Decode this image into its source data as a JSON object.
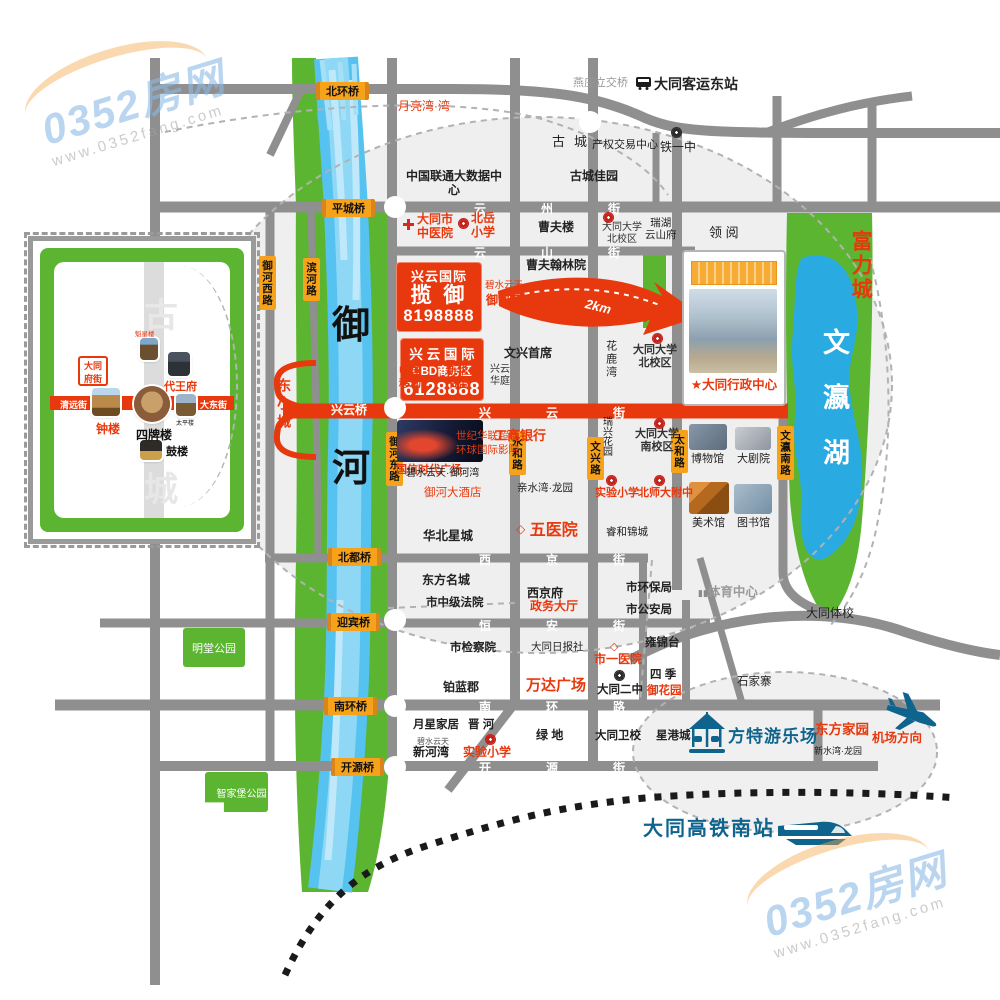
{
  "brand": {
    "name": "0352房网",
    "url": "www.0352fang.com"
  },
  "colors": {
    "red": "#e8380d",
    "orange": "#f7a21b",
    "green": "#5cb531",
    "lake": "#29abe2",
    "river": "#56c2f0",
    "teal": "#0f648e",
    "road": "#8f8f8f"
  },
  "icons": {
    "diamond": "◇",
    "star": "★",
    "building": "▮▮"
  },
  "projects": {
    "lanyu": {
      "brand": "兴云国际",
      "name": "揽  御",
      "phone": "8198888",
      "nearby_small": "碧水云天",
      "nearby_big": "御河苑"
    },
    "cbd": {
      "brand": "兴 云 国 际",
      "name": "CBD商务区",
      "phone": "6128888"
    },
    "distance": "2km",
    "admin_center": "★大同行政中心"
  },
  "bridges": {
    "beihuan": "北环桥",
    "pingcheng": "平城桥",
    "xingyun": "兴云桥",
    "beidu": "北都桥",
    "yingbin": "迎宾桥",
    "nanhuan": "南环桥",
    "kaiyuan": "开源桥"
  },
  "streets": {
    "yunzhou": "云州街",
    "yunshan": "云山街",
    "xingyun": "兴云街",
    "xijing": "西京街",
    "hengan": "恒安街",
    "nanhuan": "南环路",
    "kaiyuan": "开源街"
  },
  "vroads": {
    "yuhexi": "御河西路",
    "binhe": "滨河路",
    "yuhedong": "御河东路",
    "yonghe": "永和路",
    "wenxing": "文兴路",
    "taihe": "太和路",
    "wenyingnan": "文瀛南路"
  },
  "areas": {
    "yuhe_1": "御",
    "yuhe_2": "河",
    "dongxiaocheng": "东小城",
    "fuli": "富力城",
    "wenyinghu": "文瀛湖",
    "gucheng": "古城"
  },
  "transit": {
    "yanzhuang": "燕庄立交桥",
    "keyundong": "大同客运东站",
    "hsr": "大同高铁南站",
    "airport": "机场方向",
    "fangte": "方特游乐场"
  },
  "places": {
    "yueliangwan": "月亮湾·湾",
    "liantong": "中国联通大数据中心",
    "guchengjiayuan": "古城佳园",
    "chanquan": "产权交易中心",
    "tieyizhong": "铁一中",
    "zhongyiyuan": "大同市\n中医院",
    "beiyuexiaoxue": "北岳\n小学",
    "caofulou": "曹夫楼",
    "daxue_bei": "大同大学\n北校区",
    "ruihuyunshanfu": "瑞湖\n云山府",
    "lingyue": "领 阅",
    "caofuhanlinyuan": "曹夫翰林院",
    "wenxingshouxi": "文兴首席",
    "hualuwan": "花鹿湾",
    "daxue_bei2": "大同大学\n北校区",
    "zhongguoyidong": "中国\n移动",
    "xinhuashudian": "新华\n书店",
    "xingyunhuating": "兴云\n华庭",
    "guoxin": "国信时代广场",
    "shijihualian": "世纪华联超市\n环球国际影院",
    "gongshangyinhang": "工商银行",
    "ruixinghuayuan": "瑞兴花园",
    "daxue_nan": "大同大学\n南校区",
    "bowuguan": "博物馆",
    "dajuyuan": "大剧院",
    "meishuguan": "美术馆",
    "tushuguan": "图书馆",
    "bishuiyuhewan": "碧水云天·御河湾",
    "yuhedajiudian": "御河大酒店",
    "qinshuiwanlongyuan": "亲水湾·龙园",
    "shiyanxiaoxue": "实验小学",
    "beishidafuzhong": "北师大附中",
    "huabeixingcheng": "华北星城",
    "wuyiyuan": "五医院",
    "ruihejincheng": "睿和锦城",
    "dongfangmingcheng": "东方名城",
    "xijingfu": "西京府",
    "shihuanbaoju": "市环保局",
    "shizhongjifayuan": "市中级法院",
    "zhengwudating": "政务大厅",
    "shigonganju": "市公安局",
    "tiyuzhongxin": "体育中心",
    "datongtixiao": "大同体校",
    "yongjintai": "雍锦台",
    "shijianchayuan": "市检察院",
    "datongribaoshe": "大同日报社",
    "shiyiyiyuan": "市一医院",
    "bolanjun": "铂蓝郡",
    "wandaguangchang": "万达广场",
    "datongerzhong": "大同二中",
    "siji": "四 季",
    "yuhuayuan": "御花园",
    "shijiazhai": "石家寨",
    "yuexingjiaju": "月星家居",
    "jinhe": "晋 河",
    "bishuiyuntian": "碧水云天",
    "xinhewan": "新河湾",
    "shiyanxiaoxue2": "实验小学",
    "lvdi": "绿 地",
    "datongweixiao": "大同卫校",
    "xinggangcheng": "星港城",
    "dongfangjiayuan": "东方家园",
    "xinshuiwanlongyuan": "新水湾·龙园",
    "mingtanggongyuan": "明堂公园",
    "zhijiabaogongyuan": "智家堡公园"
  },
  "inset": {
    "ghost_top": "古",
    "ghost_bottom": "城",
    "stamp": "大同\n府街",
    "kuixinglou": "魁星楼",
    "daiwangfu": "代王府",
    "qingyuanjie": "清远街",
    "zhonglou": "钟楼",
    "sipailou": "四牌楼",
    "taipinglou": "太平楼",
    "dadongjie": "大东街",
    "gulou": "鼓楼"
  }
}
